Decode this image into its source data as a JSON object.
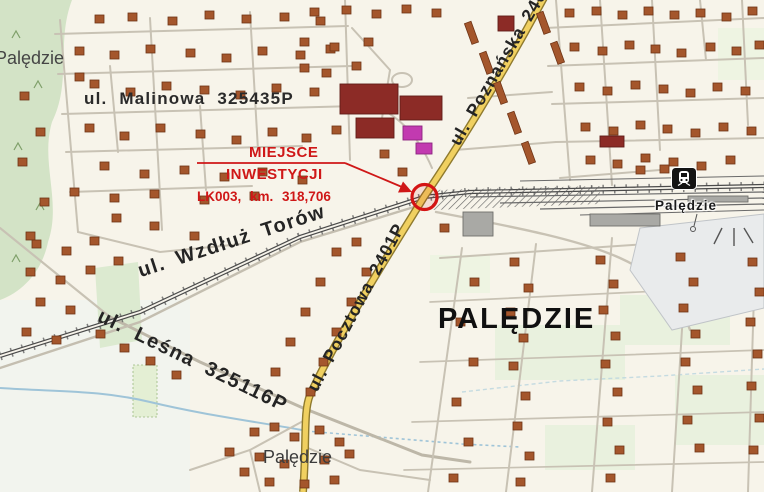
{
  "map": {
    "labels": {
      "place_top_left": "Palędzie",
      "street_malinowa": "ul. Malinowa 325435P",
      "street_poznanska": "ul. Poznańska 2401P",
      "street_wzdluz_torow": "ul. Wzdłuż Torów",
      "street_pocztowa": "ul. Pocztowa 2401P",
      "street_lesna": "ul. Leśna 325116P",
      "town_main": "PALĘDZIE",
      "village_south": "Palędzie",
      "station": "Palędzie"
    },
    "annotation": {
      "title_line1": "MIEJSCE",
      "title_line2": "INWESTYCJI",
      "detail": "LK003, km. 318,706",
      "color": "#cf1717"
    },
    "icons": {
      "station_icon": "railway-station-icon",
      "marker": "investment-location-marker"
    },
    "colors": {
      "background": "#f7f4ea",
      "major_road": "#f0d060",
      "building": "#a4562c",
      "public_building": "#8c2b26",
      "special_building": "#c23ab0",
      "green_area": "#d3e3c6",
      "annotation_red": "#cf1717"
    }
  }
}
